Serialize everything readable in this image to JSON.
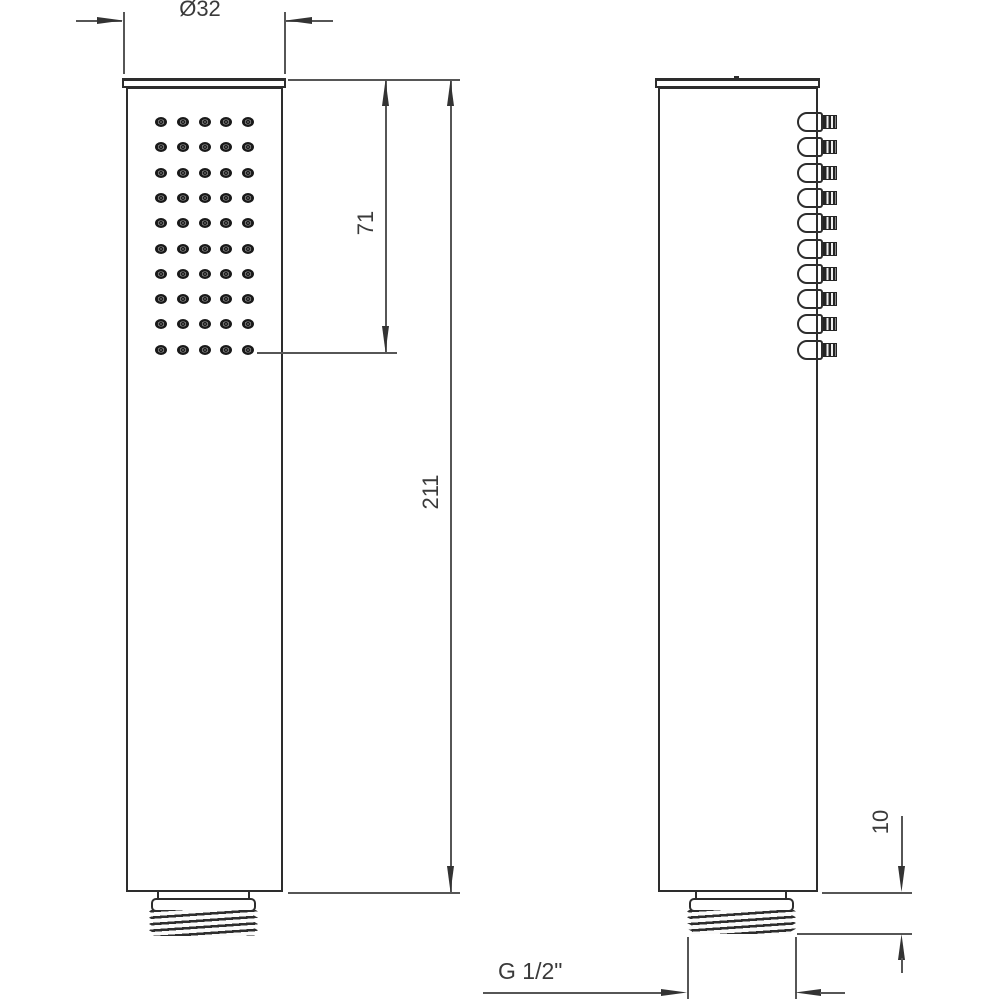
{
  "colors": {
    "outline": "#2d2d2d",
    "dim_line": "#565656",
    "text": "#3a3a3a",
    "background": "#ffffff"
  },
  "front_view": {
    "nozzle_rows": 10,
    "nozzle_cols": 5
  },
  "side_view": {
    "nozzle_count": 10
  },
  "dimensions": {
    "head_width": "Ø32",
    "spray_face_length": "71",
    "total_length": "211",
    "thread_length": "10",
    "thread_spec": "G 1/2\""
  }
}
